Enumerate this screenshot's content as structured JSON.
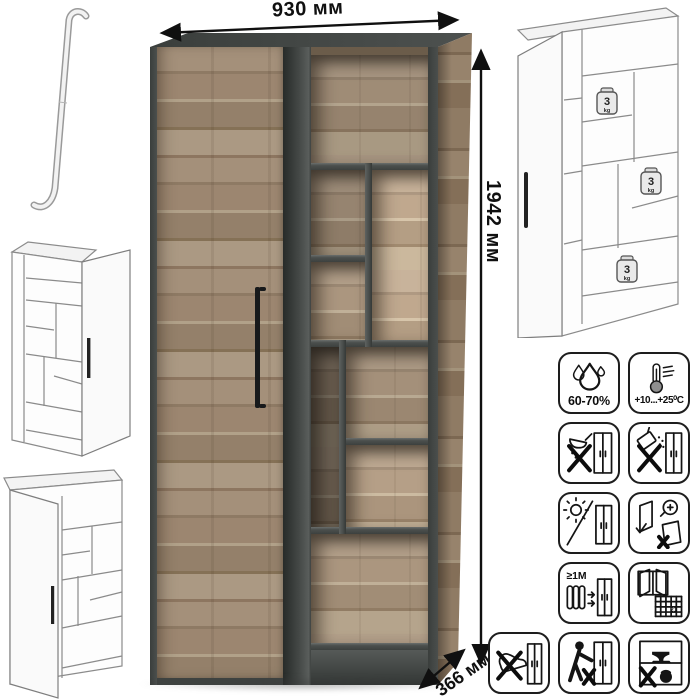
{
  "dimensions": {
    "width": "930 мм",
    "height": "1942 мм",
    "depth": "366 мм"
  },
  "load_badges": {
    "value": "3",
    "unit": "kg",
    "count": 3
  },
  "care_icons": [
    {
      "name": "humidity-icon",
      "label": "60-70%"
    },
    {
      "name": "temperature-range-icon",
      "label": "+10...+25⁰С"
    },
    {
      "name": "no-spilled-liquids-icon",
      "label": ""
    },
    {
      "name": "no-abrasive-cleaners-icon",
      "label": ""
    },
    {
      "name": "no-direct-sunlight-icon",
      "label": ""
    },
    {
      "name": "door-adjustment-check-icon",
      "label": ""
    },
    {
      "name": "heat-source-distance-icon",
      "label": "≥1М"
    },
    {
      "name": "room-ventilation-icon",
      "label": "21"
    },
    {
      "name": "no-foot-pushing-icon",
      "label": ""
    },
    {
      "name": "no-dragging-icon",
      "label": ""
    },
    {
      "name": "no-shelf-overload-icon",
      "label": ""
    }
  ],
  "colors": {
    "wood_light": "#b1a189",
    "wood_mid": "#9c8670",
    "wood_dark": "#857156",
    "carcass_graphite": "#454947",
    "line_black": "#101010"
  }
}
